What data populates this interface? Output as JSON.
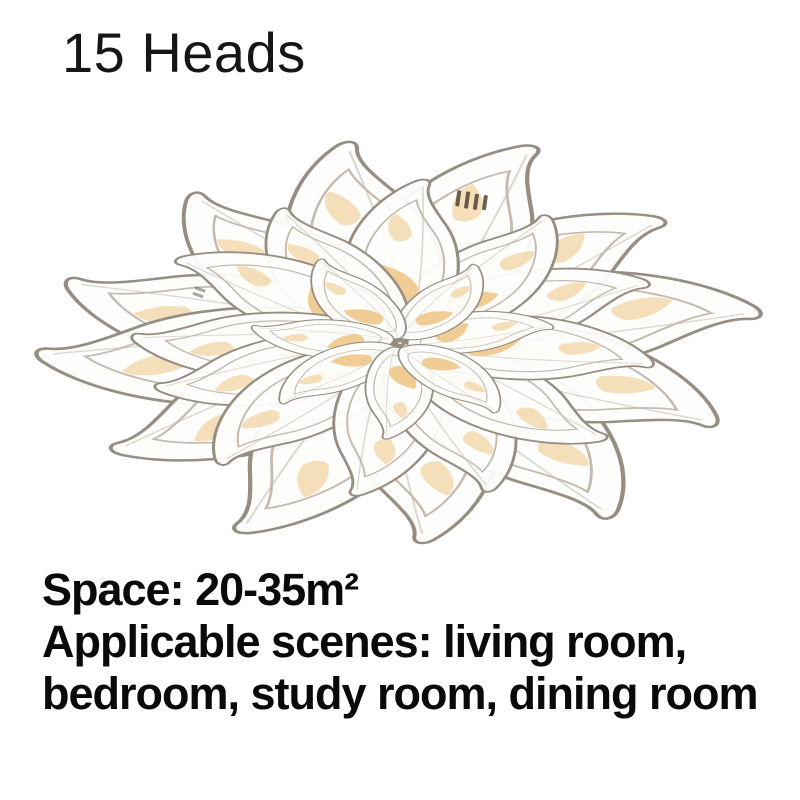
{
  "page": {
    "background_color": "#ffffff"
  },
  "header": {
    "heads_label": "15 Heads"
  },
  "product_image": {
    "alt": "15-head acrylic petal flower LED ceiling light, lit with warm white glow",
    "heads_count": "15",
    "colors": {
      "petal_fill": "#fdfdfb",
      "petal_stroke": "#978e83",
      "petal_inner_stroke": "#c3bab0",
      "accent_amber": "#ecc17a",
      "base_glow": "#f0ddb2",
      "glow_mid": "#f6e9c9",
      "grille_dark": "#4a3a28"
    }
  },
  "specs": {
    "space_line": "Space: 20-35m²",
    "scenes_line_1": "Applicable scenes: living room,",
    "scenes_line_2": "bedroom, study room, dining room"
  }
}
